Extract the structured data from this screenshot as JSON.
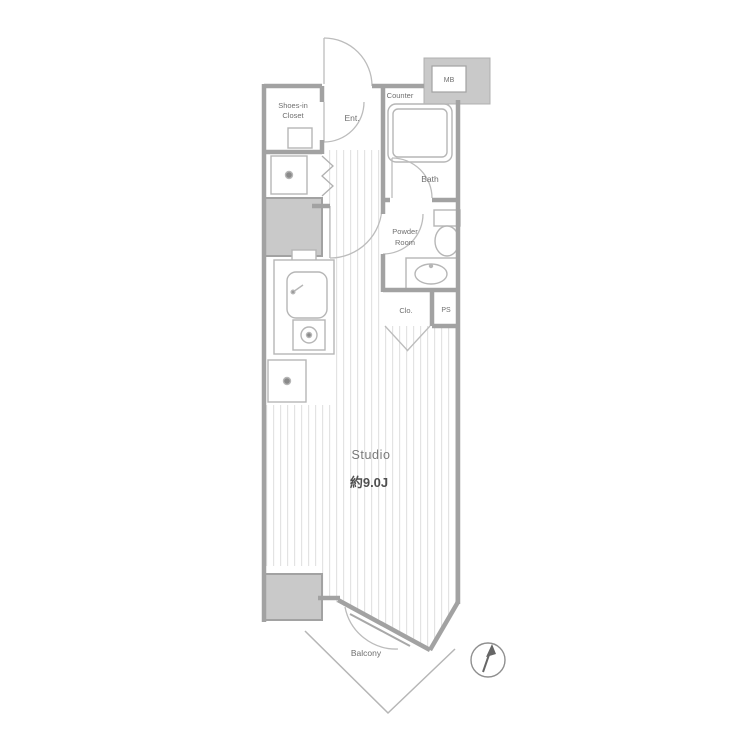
{
  "plan": {
    "type": "apartment-floor-plan",
    "labels": {
      "shoes_closet_line1": "Shoes-in",
      "shoes_closet_line2": "Closet",
      "entrance": "Ent.",
      "counter": "Counter",
      "meter_box": "MB",
      "bath": "Bath",
      "powder_line1": "Powder",
      "powder_line2": "Room",
      "closet": "Clo.",
      "pipe_space": "PS",
      "studio": "Studio",
      "studio_area": "約9.0J",
      "balcony": "Balcony"
    },
    "icons": {
      "compass": "compass-north-arrow",
      "washing_machine": "square-with-dot",
      "refrigerator": "square-with-dot",
      "stove": "burner-circle",
      "sink": "rounded-basin",
      "toilet": "toilet-bowl",
      "bathtub": "double-rounded-rect"
    },
    "colors": {
      "wall": "#a2a2a2",
      "shaft_fill": "#c9c9c9",
      "fixture_line": "#b6b6b6",
      "floor_stripe": "#e3e3e3",
      "text": "#6f6f6f",
      "compass_needle": "#666666"
    }
  }
}
